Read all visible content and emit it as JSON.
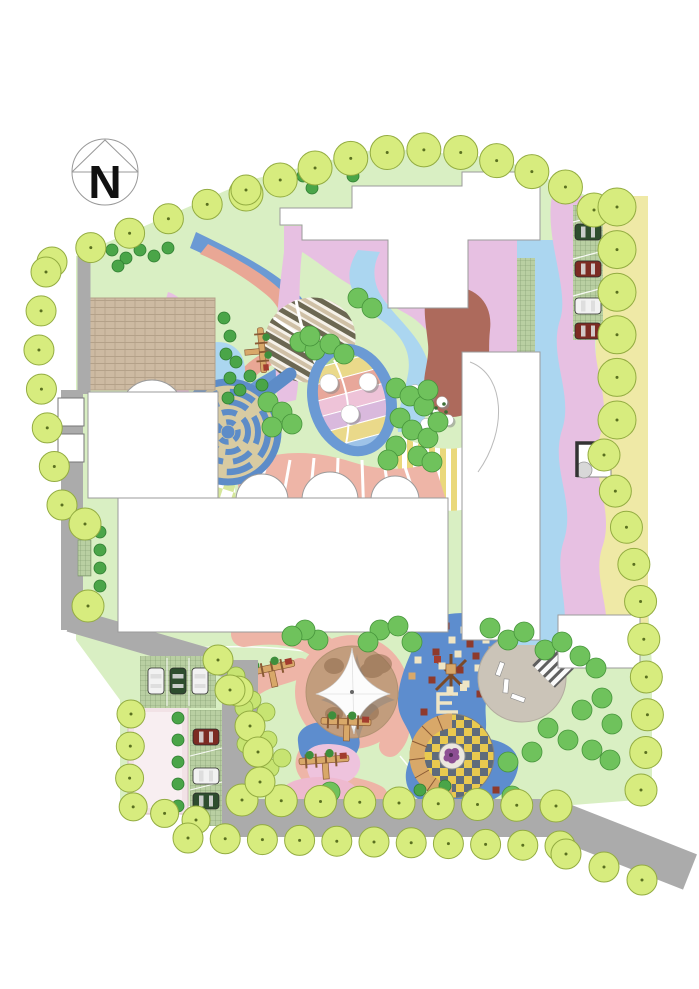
{
  "compass": {
    "label": "N"
  },
  "palette": {
    "page_bg": "#ffffff",
    "road": "#ababab",
    "lawn": "#d9efc3",
    "building": "#ffffff",
    "building_outline": "#9b9b9b",
    "tree_perimeter": "#d7ec7e",
    "tree_perimeter_edge": "#93ac41",
    "tree_medium": "#6fc25c",
    "tree_dark": "#4aa548",
    "tree_yellowgreen": "#c7e472",
    "band_lilac": "#e7c0e2",
    "band_blue": "#6b9ad4",
    "band_lightblue": "#abd6f0",
    "band_salmon": "#e9a795",
    "band_green": "#b8dd96",
    "band_yellow": "#efe9a6",
    "path_pink": "#eeb5a7",
    "terracotta": "#ad6a5c",
    "plaza_brick": "#cdbaa2",
    "plaza_gray": "#cbc4b8",
    "sand": "#c29d7d",
    "sand_dark": "#8f6b4c",
    "maze_blue": "#5d8cc8",
    "maze_path": "#d8cba2",
    "checker_yellow": "#e9c94f",
    "checker_slate": "#5f6b7b",
    "paving_checker_green": "#d5e69a",
    "stripes_yellow": "#ead87b",
    "play_blue": "#5d8dce",
    "tile_cream": "#efe5c4",
    "tile_red": "#8e3a2c",
    "wood": "#d8a869",
    "wood_dark": "#8a5a34",
    "grid_paving": "#b9cfa2",
    "grid_line": "#7d986b",
    "pink_plaza": "#f2e2e6",
    "car_green": "#2e4d2e",
    "car_red": "#7c2b23",
    "car_white": "#f2f2f2",
    "flower_purple": "#8d4f93"
  },
  "trees": {
    "chains": [
      {
        "name": "north-boundary",
        "r": 17,
        "count": 11,
        "path": [
          [
            246,
            194
          ],
          [
            300,
            172
          ],
          [
            356,
            157
          ],
          [
            412,
            149
          ],
          [
            468,
            153
          ],
          [
            524,
            168
          ],
          [
            572,
            190
          ],
          [
            594,
            210
          ]
        ]
      },
      {
        "name": "northwest-diagonal",
        "r": 15,
        "count": 6,
        "path": [
          [
            52,
            262
          ],
          [
            246,
            190
          ]
        ]
      },
      {
        "name": "west-column",
        "r": 15,
        "count": 7,
        "path": [
          [
            46,
            272
          ],
          [
            38,
            335
          ],
          [
            42,
            398
          ],
          [
            52,
            455
          ],
          [
            62,
            505
          ]
        ]
      },
      {
        "name": "west-mid",
        "r": 16,
        "count": 2,
        "path": [
          [
            85,
            524
          ],
          [
            88,
            606
          ]
        ]
      },
      {
        "name": "east-parking-column",
        "r": 19,
        "count": 6,
        "path": [
          [
            617,
            207
          ],
          [
            617,
            420
          ]
        ]
      },
      {
        "name": "east-diagonal",
        "r": 16,
        "count": 10,
        "path": [
          [
            604,
            455
          ],
          [
            626,
            525
          ],
          [
            640,
            595
          ],
          [
            646,
            665
          ],
          [
            648,
            735
          ],
          [
            641,
            790
          ]
        ]
      },
      {
        "name": "plaza-border",
        "r": 14,
        "count": 6,
        "path": [
          [
            131,
            714
          ],
          [
            129,
            806
          ],
          [
            196,
            820
          ]
        ]
      },
      {
        "name": "garden-road-west",
        "r": 15,
        "count": 3,
        "path": [
          [
            218,
            660
          ],
          [
            240,
            694
          ],
          [
            250,
            726
          ]
        ]
      },
      {
        "name": "bottom-inner-row",
        "r": 16,
        "count": 9,
        "path": [
          [
            242,
            800
          ],
          [
            556,
            806
          ]
        ]
      },
      {
        "name": "bottom-outer-row",
        "r": 15,
        "count": 11,
        "path": [
          [
            188,
            838
          ],
          [
            560,
            846
          ]
        ]
      },
      {
        "name": "southeast-exit",
        "r": 15,
        "count": 3,
        "path": [
          [
            566,
            854
          ],
          [
            642,
            880
          ]
        ]
      }
    ],
    "perimeter_singles": [
      [
        258,
        752
      ],
      [
        260,
        782
      ],
      [
        230,
        690
      ]
    ],
    "medium": [
      [
        396,
        388
      ],
      [
        410,
        396
      ],
      [
        424,
        406
      ],
      [
        400,
        418
      ],
      [
        412,
        430
      ],
      [
        428,
        438
      ],
      [
        396,
        446
      ],
      [
        418,
        456
      ],
      [
        432,
        462
      ],
      [
        388,
        460
      ],
      [
        438,
        422
      ],
      [
        428,
        390
      ],
      [
        268,
        402
      ],
      [
        282,
        412
      ],
      [
        292,
        424
      ],
      [
        272,
        427
      ],
      [
        300,
        342
      ],
      [
        315,
        350
      ],
      [
        330,
        344
      ],
      [
        344,
        354
      ],
      [
        310,
        336
      ],
      [
        358,
        298
      ],
      [
        372,
        308
      ],
      [
        380,
        630
      ],
      [
        398,
        626
      ],
      [
        412,
        642
      ],
      [
        368,
        642
      ],
      [
        318,
        640
      ],
      [
        305,
        630
      ],
      [
        292,
        636
      ],
      [
        490,
        628
      ],
      [
        508,
        640
      ],
      [
        524,
        632
      ],
      [
        545,
        650
      ],
      [
        562,
        642
      ],
      [
        580,
        656
      ],
      [
        596,
        668
      ],
      [
        582,
        710
      ],
      [
        602,
        698
      ],
      [
        612,
        724
      ],
      [
        548,
        728
      ],
      [
        568,
        740
      ],
      [
        592,
        750
      ],
      [
        610,
        760
      ],
      [
        532,
        752
      ],
      [
        508,
        762
      ],
      [
        330,
        792
      ],
      [
        512,
        796
      ]
    ],
    "dark": [
      [
        112,
        250
      ],
      [
        126,
        258
      ],
      [
        140,
        250
      ],
      [
        118,
        266
      ],
      [
        154,
        256
      ],
      [
        168,
        248
      ],
      [
        224,
        318
      ],
      [
        230,
        336
      ],
      [
        226,
        354
      ],
      [
        236,
        362
      ],
      [
        230,
        378
      ],
      [
        240,
        390
      ],
      [
        228,
        398
      ],
      [
        303,
        176
      ],
      [
        312,
        188
      ],
      [
        345,
        166
      ],
      [
        353,
        176
      ],
      [
        100,
        532
      ],
      [
        100,
        550
      ],
      [
        100,
        568
      ],
      [
        100,
        586
      ],
      [
        178,
        718
      ],
      [
        178,
        740
      ],
      [
        178,
        762
      ],
      [
        178,
        784
      ],
      [
        178,
        806
      ],
      [
        250,
        376
      ],
      [
        262,
        385
      ],
      [
        420,
        790
      ],
      [
        445,
        786
      ]
    ],
    "yellowgreen": [
      [
        252,
        700
      ],
      [
        266,
        712
      ],
      [
        254,
        726
      ],
      [
        268,
        740
      ],
      [
        256,
        754
      ],
      [
        270,
        768
      ],
      [
        282,
        758
      ],
      [
        246,
        744
      ],
      [
        244,
        708
      ],
      [
        236,
        676
      ]
    ]
  },
  "cars": [
    {
      "x": 588,
      "y": 232,
      "rot": 0,
      "color": "car_green"
    },
    {
      "x": 588,
      "y": 269,
      "rot": 0,
      "color": "car_red"
    },
    {
      "x": 588,
      "y": 306,
      "rot": 0,
      "color": "car_white"
    },
    {
      "x": 588,
      "y": 331,
      "rot": 0,
      "color": "car_red"
    },
    {
      "x": 156,
      "y": 681,
      "rot": 90,
      "color": "car_white"
    },
    {
      "x": 178,
      "y": 681,
      "rot": 90,
      "color": "car_green"
    },
    {
      "x": 200,
      "y": 681,
      "rot": 90,
      "color": "car_white"
    },
    {
      "x": 206,
      "y": 737,
      "rot": 0,
      "color": "car_red"
    },
    {
      "x": 206,
      "y": 776,
      "rot": 0,
      "color": "car_white"
    },
    {
      "x": 206,
      "y": 801,
      "rot": 0,
      "color": "car_green"
    }
  ],
  "play_tiles": [
    [
      446,
      626,
      "tile_red"
    ],
    [
      464,
      630,
      "tile_cream"
    ],
    [
      480,
      626,
      "tile_red"
    ],
    [
      452,
      640,
      "tile_cream"
    ],
    [
      470,
      644,
      "tile_red"
    ],
    [
      486,
      640,
      "tile_cream"
    ],
    [
      436,
      652,
      "tile_red"
    ],
    [
      458,
      654,
      "tile_cream"
    ],
    [
      476,
      656,
      "tile_red"
    ],
    [
      492,
      650,
      "wood"
    ],
    [
      442,
      666,
      "tile_cream"
    ],
    [
      460,
      670,
      "tile_red"
    ],
    [
      478,
      668,
      "tile_cream"
    ],
    [
      432,
      680,
      "tile_red"
    ],
    [
      466,
      684,
      "tile_cream"
    ],
    [
      490,
      680,
      "tile_red"
    ],
    [
      450,
      690,
      "tile_cream"
    ],
    [
      480,
      694,
      "tile_red"
    ],
    [
      424,
      712,
      "tile_red"
    ],
    [
      500,
      710,
      "tile_cream"
    ],
    [
      426,
      792,
      "tile_cream"
    ],
    [
      446,
      800,
      "tile_red"
    ],
    [
      470,
      802,
      "tile_cream"
    ],
    [
      496,
      790,
      "tile_red"
    ],
    [
      418,
      660,
      "tile_cream"
    ],
    [
      412,
      676,
      "wood"
    ]
  ],
  "stepping_stones": [
    [
      415,
      390
    ],
    [
      428,
      396
    ],
    [
      442,
      402
    ],
    [
      420,
      408
    ],
    [
      434,
      414
    ],
    [
      448,
      420
    ],
    [
      426,
      424
    ]
  ],
  "leaf_stones": [
    [
      329,
      383
    ],
    [
      368,
      382
    ],
    [
      350,
      414
    ]
  ],
  "lawn_dots": [
    [
      428,
      402
    ],
    [
      436,
      408
    ],
    [
      444,
      404
    ],
    [
      432,
      414
    ],
    [
      440,
      417
    ],
    [
      430,
      396
    ],
    [
      446,
      412
    ]
  ]
}
